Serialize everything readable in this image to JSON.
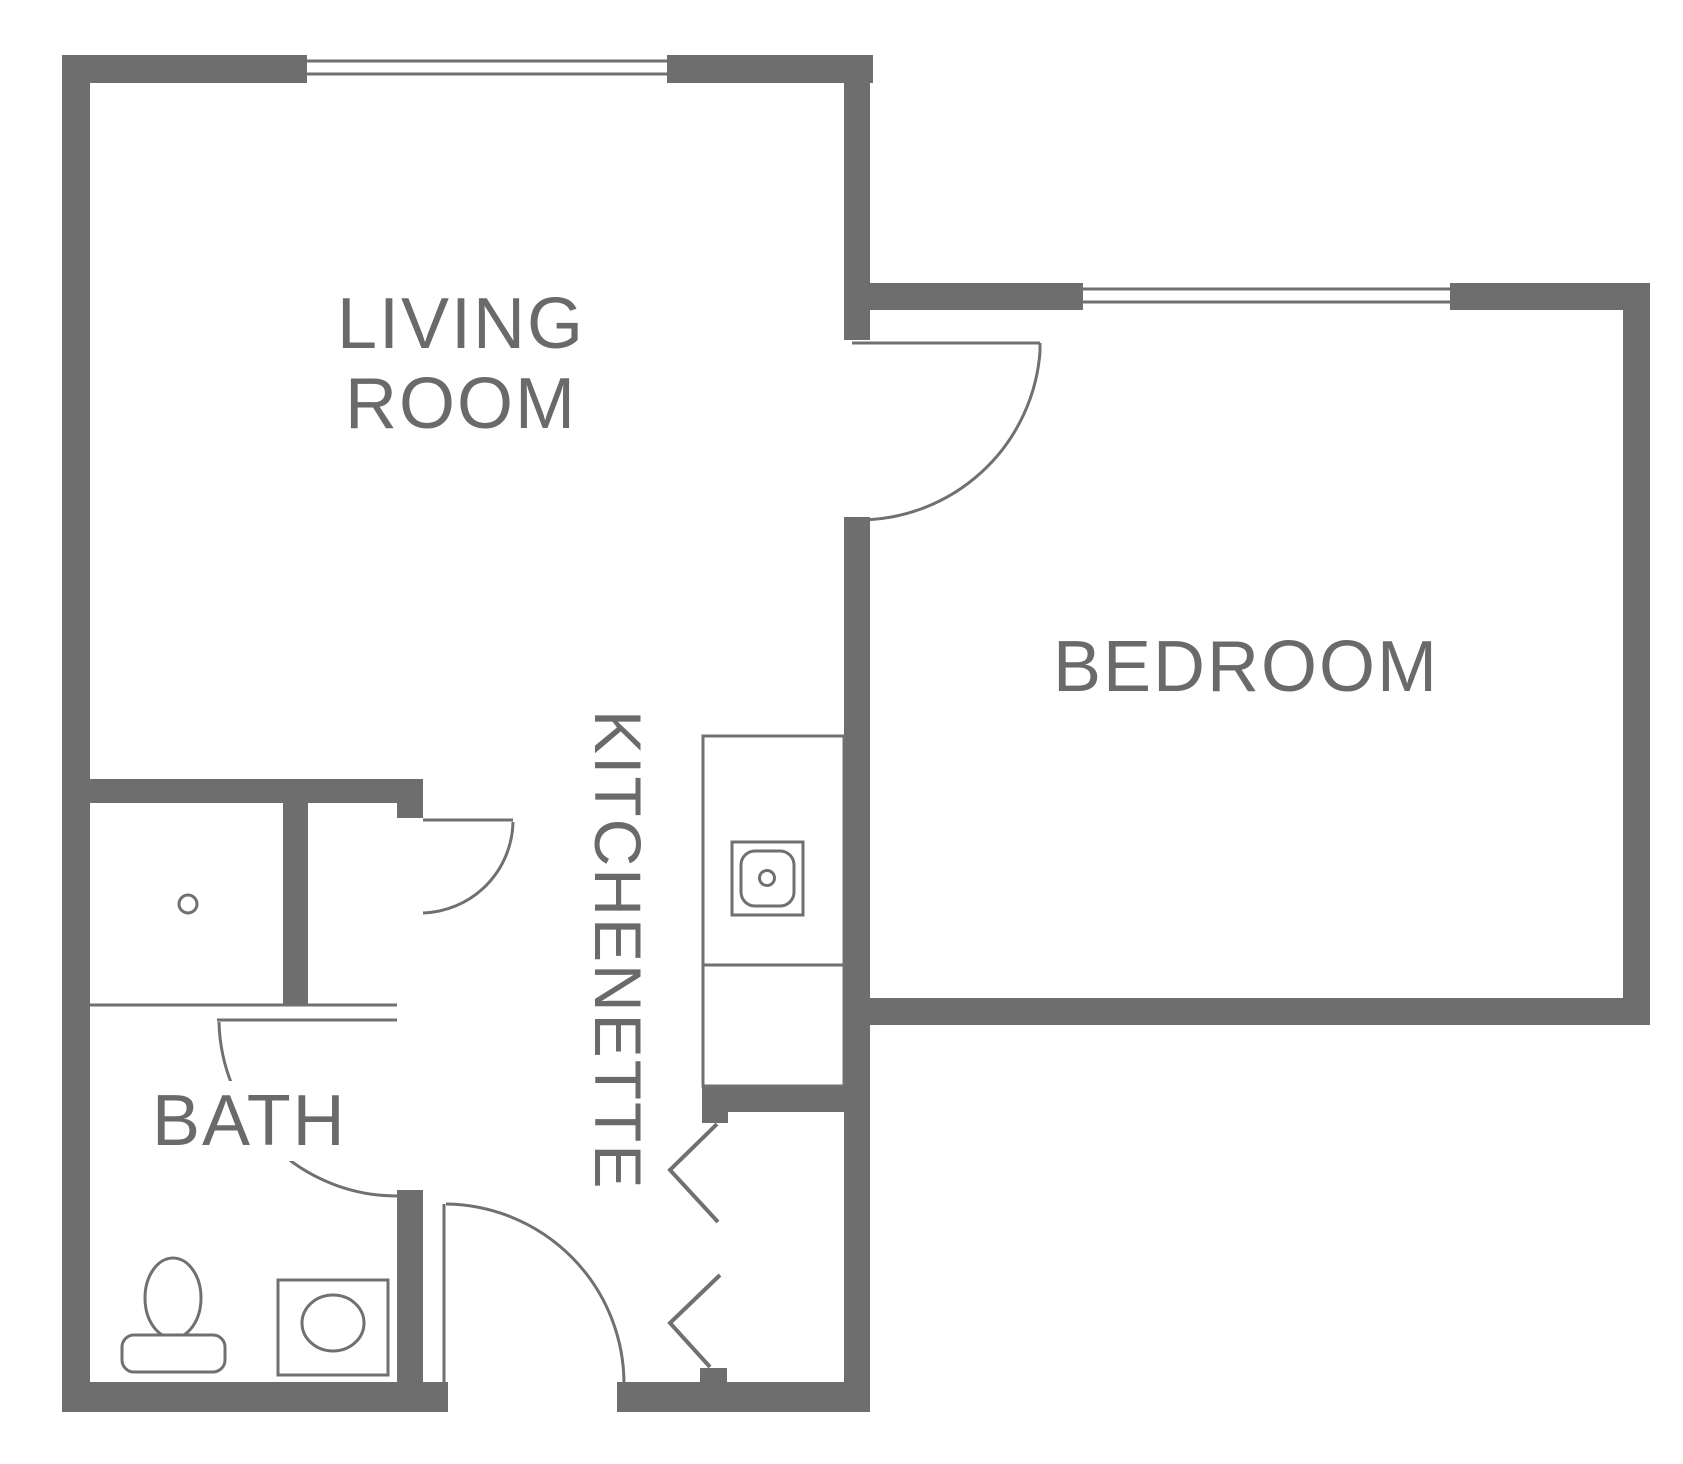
{
  "title": "One-bedroom apartment floor plan",
  "rooms": {
    "living_room": {
      "label_line1": "LIVING",
      "label_line2": "ROOM"
    },
    "bedroom": {
      "label": "BEDROOM"
    },
    "kitchenette": {
      "label": "KITCHENETTE"
    },
    "bath": {
      "label": "BATH"
    }
  },
  "fixtures": {
    "shower": "shower-with-drain",
    "kitchen_sink": "kitchen-sink",
    "toilet": "toilet",
    "bath_sink": "bathroom-sink",
    "closet_doors": "bifold-closet-doors",
    "windows": 2,
    "door_swings": 4
  },
  "colors": {
    "wall": "#6e6e6e",
    "line": "#707070",
    "text": "#6a6a6a",
    "background": "#ffffff"
  }
}
